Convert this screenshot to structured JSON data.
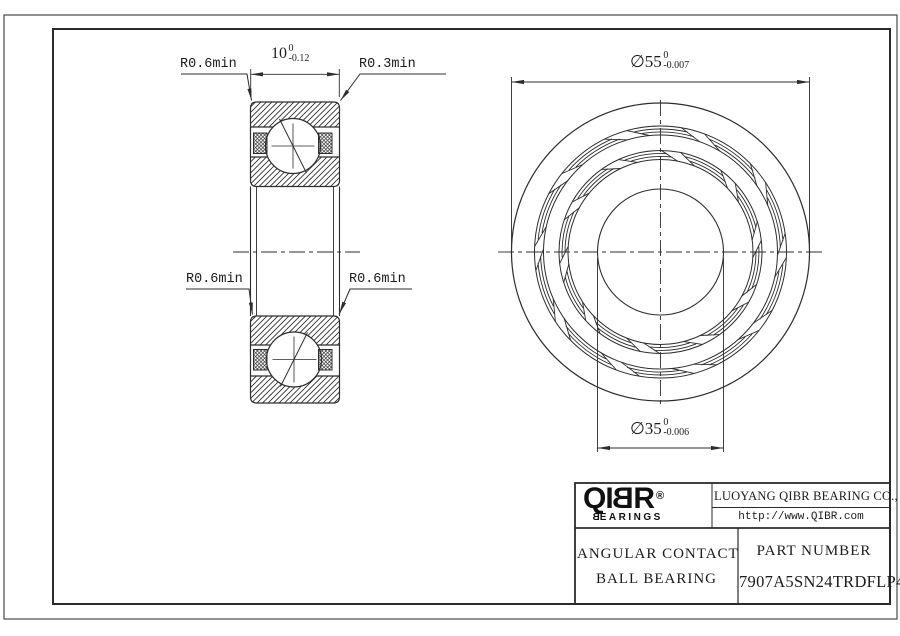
{
  "colors": {
    "line": "#2d2d2d",
    "frame": "#2b2b2b",
    "outer_border": "#4a4a4a",
    "text": "#1c1c1c",
    "background": "#ffffff"
  },
  "annotations": {
    "radius_top_left": "R0.6min",
    "radius_top_right": "R0.3min",
    "radius_bottom_left": "R0.6min",
    "radius_bottom_right": "R0.6min",
    "width_dim": {
      "value": "10",
      "upper": "0",
      "lower": "-0.12"
    },
    "outer_dia_dim": {
      "value": "∅55",
      "upper": "0",
      "lower": "-0.007"
    },
    "bore_dia_dim": {
      "value": "∅35",
      "upper": "0",
      "lower": "-0.006"
    }
  },
  "title_block": {
    "logo_part1": "QI",
    "logo_part2": "B",
    "logo_part3": "R",
    "logo_registered": "®",
    "logo_sub_b": "B",
    "logo_sub_rest": "EARINGS",
    "company": "LUOYANG QIBR BEARING CO., LTD",
    "website": "http://www.QIBR.com",
    "product_type_line1": "ANGULAR CONTACT",
    "product_type_line2": "BALL BEARING",
    "part_number_label": "PART NUMBER",
    "part_number": "7907A5SN24TRDFLP4"
  }
}
